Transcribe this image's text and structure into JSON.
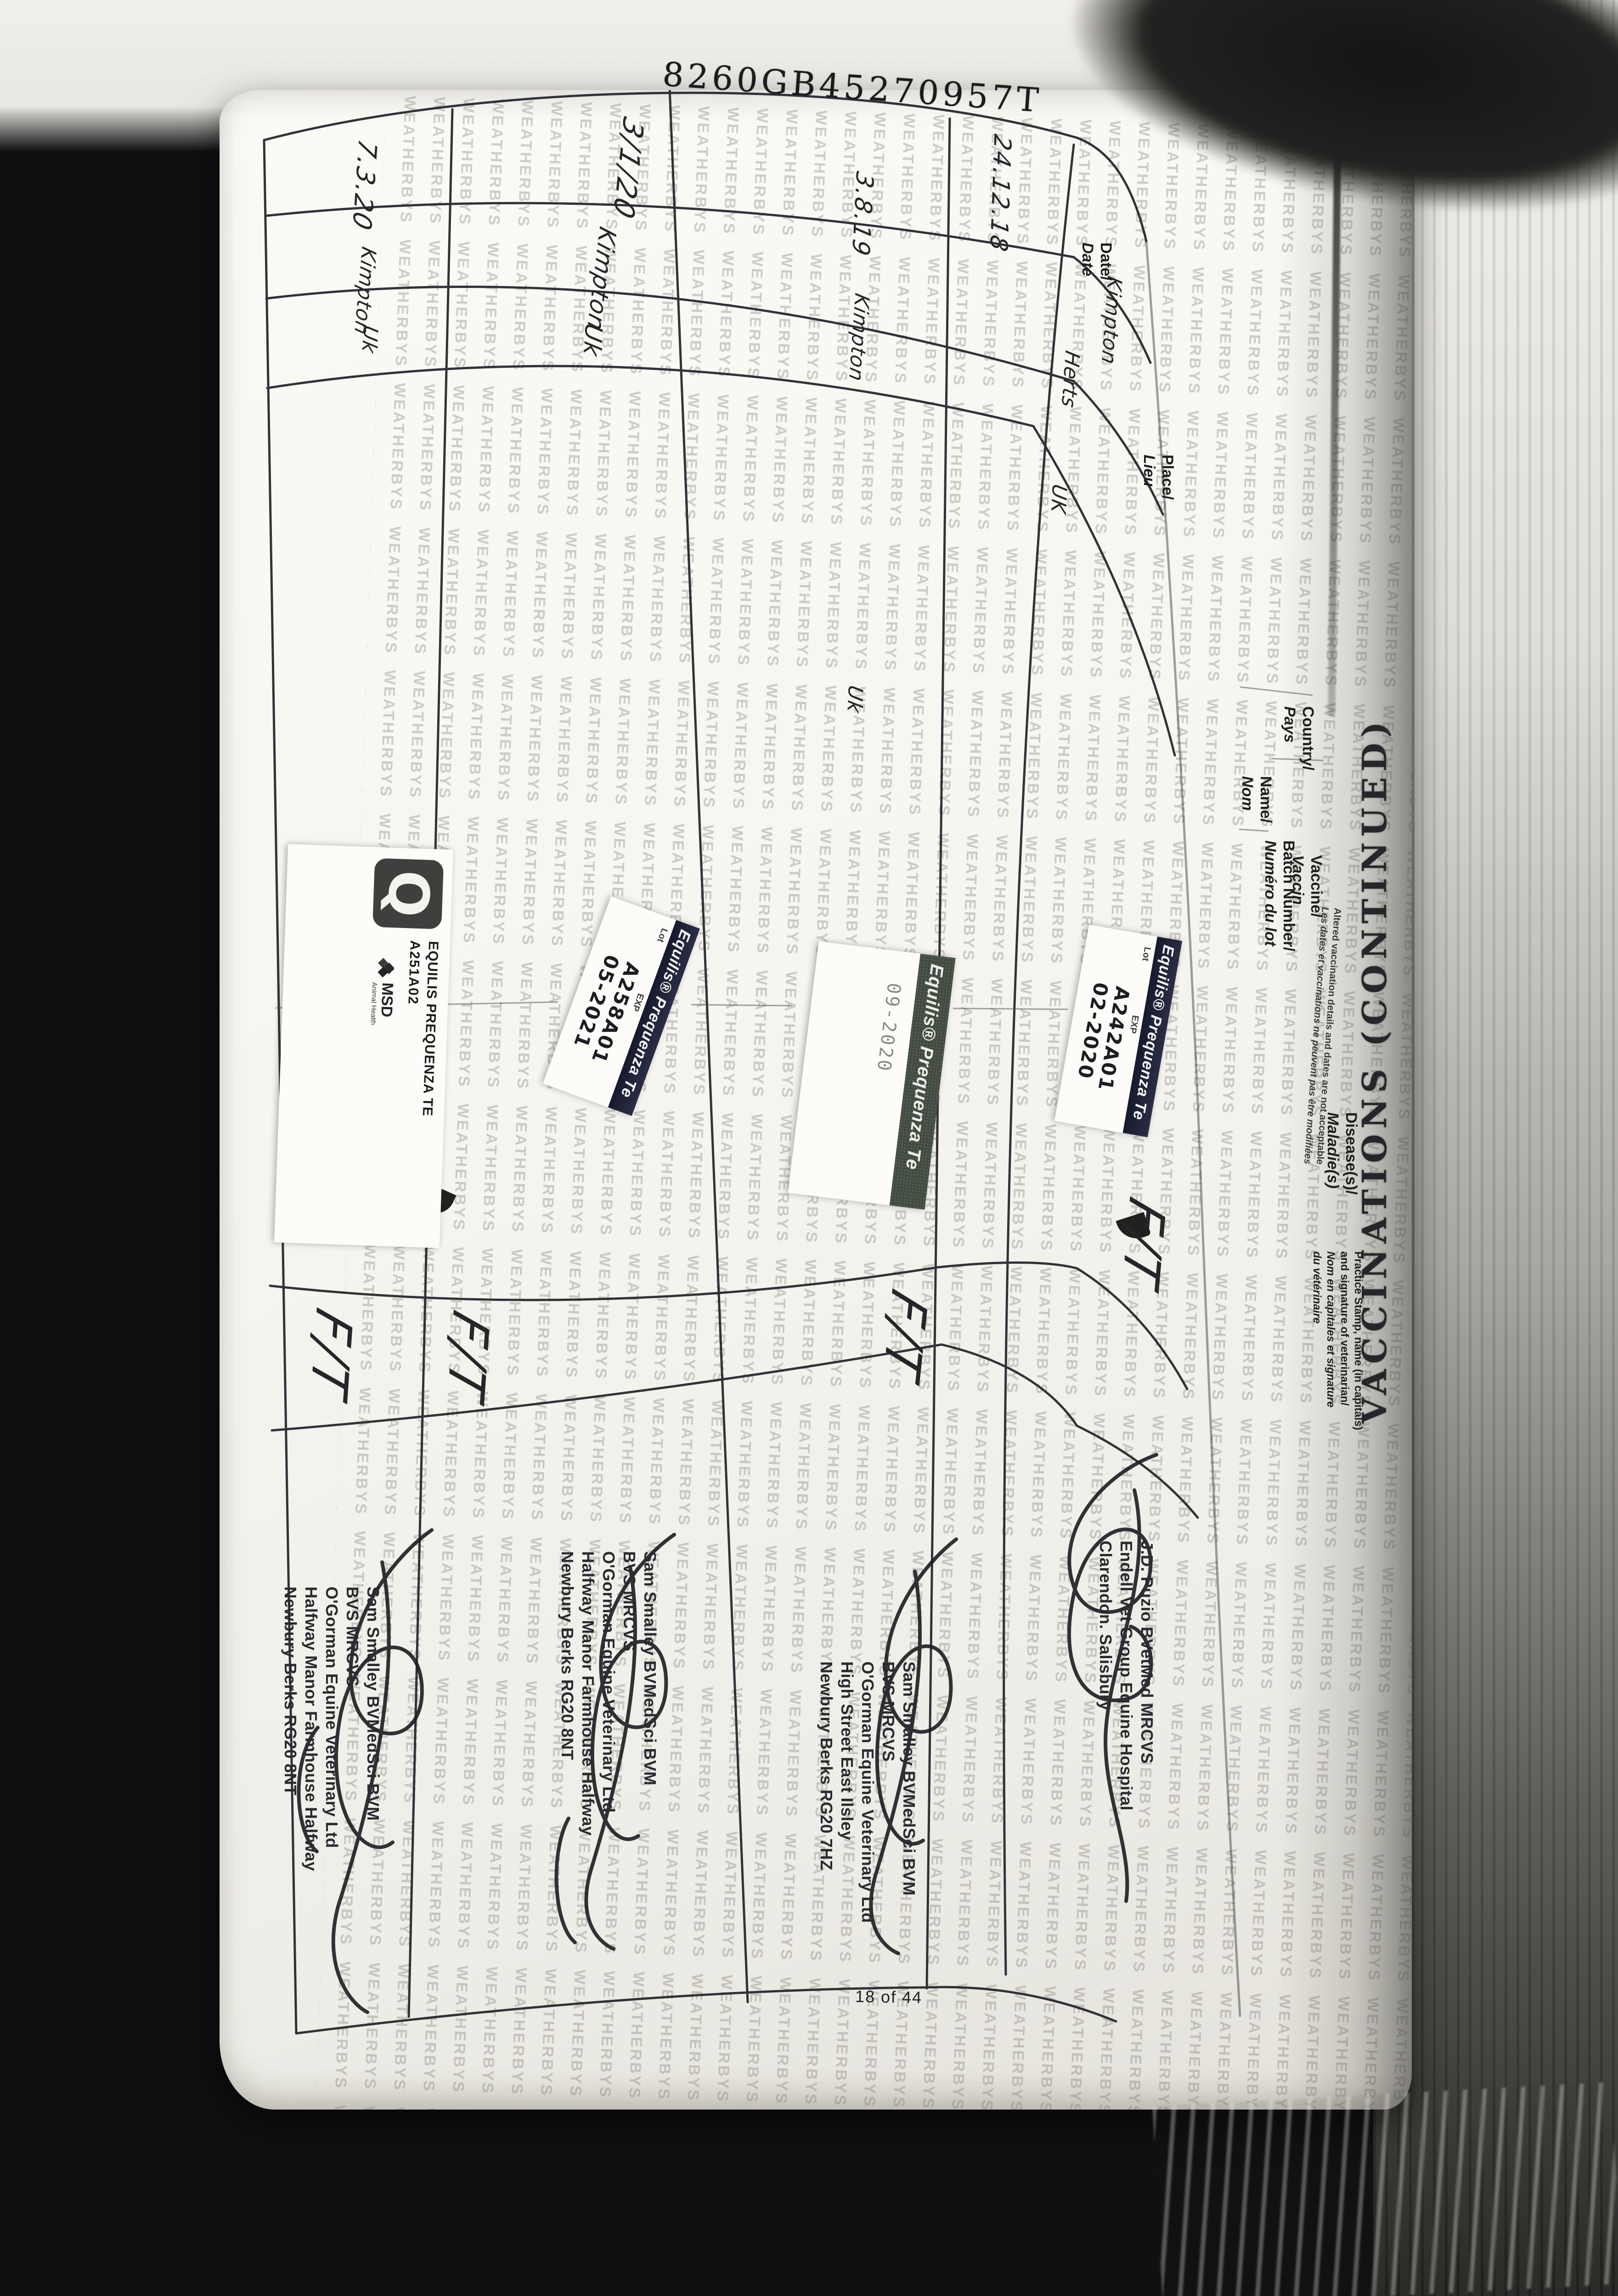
{
  "page": {
    "passport_number": "8260GB45270957T",
    "page_number": "18 of 44",
    "watermark_word": "WEATHERBYS",
    "title": "VACCINATIONS (CONTINUED)"
  },
  "table": {
    "headers": {
      "date_en": "Date/",
      "date_fr": "Date",
      "place_en": "Place/",
      "place_fr": "Lieu",
      "country_en": "Country/",
      "country_fr": "Pays",
      "name_en": "Name/",
      "name_fr": "Nom",
      "vaccine_en": "Vaccine/",
      "vaccine_fr": "Vaccin",
      "batch_en": "Batch Number/",
      "batch_fr": "Numéro du lot",
      "disease_en": "Disease(s)/",
      "disease_fr": "Maladie(s)",
      "stamp_en": "Practice Stamp, name (in capitals)\nand signature of veterinarian/",
      "stamp_fr": "Nom en capitales et signature\ndu vétérinaire"
    },
    "fine_print_en": "Altered vaccination details and dates are not acceptable",
    "fine_print_fr": "Les dates et vaccinations ne peuvent pas être modifiées"
  },
  "rows": [
    {
      "date": "24.12.18",
      "place": "Kimpton",
      "place2": "Herts",
      "country": "UK",
      "sticker": {
        "brand": "Equilis® Prequenza Te",
        "lot_label": "Lot",
        "exp_label": "EXP",
        "batch": "A242A01",
        "expiry": "02-2020"
      },
      "disease": "F/T",
      "stamp": "J.D. Puzio BVetMed MRCVS\nEndell Vet Group Equine Hospital\nClarendon. Salisbury"
    },
    {
      "date": "3.8.19",
      "place": "Kimpton",
      "country": "Uk",
      "sticker": {
        "brand": "Equilis® Prequenza Te",
        "expiry": "09-2020"
      },
      "disease": "F/T",
      "stamp": "Sam Smalley BVMedSci BVM\nBVS MRCVS\nO'Gorman Equine Veterinary Ltd\nHigh Street East Ilsley\nNewbury Berks RG20 7HZ"
    },
    {
      "date": "3/1/20",
      "place": "Kimpton",
      "country": "Uk",
      "sticker": {
        "brand": "Equilis® Prequenza Te",
        "lot_label": "Lot",
        "exp_label": "EXP",
        "batch": "A258A01",
        "expiry": "05-2021"
      },
      "disease": "F/T",
      "stamp": "Sam Smalley BVMedSci BVM\nBVS MRCVS\nO'Gorman Equine Veterinary Ltd\nHalfway Manor Farmhouse Halfway\nNewbury Berks RG20 8NT"
    },
    {
      "date": "7.3.20",
      "place": "Kimpton",
      "country": "Uk",
      "sticker": {
        "line1": "EQUILIS PREQUENZA TE",
        "line2": "A251A02",
        "q_glyph": "Q",
        "msd": "MSD",
        "msd_sub": "Animal Health"
      },
      "disease": "F/T",
      "stamp": "Sam Smalley BVMedSci BVM\nBVS MRCVS\nO'Gorman Equine Veterinary Ltd\nHalfway Manor Farmhouse Halfway\nNewbury Berks RG20 8NT"
    }
  ]
}
